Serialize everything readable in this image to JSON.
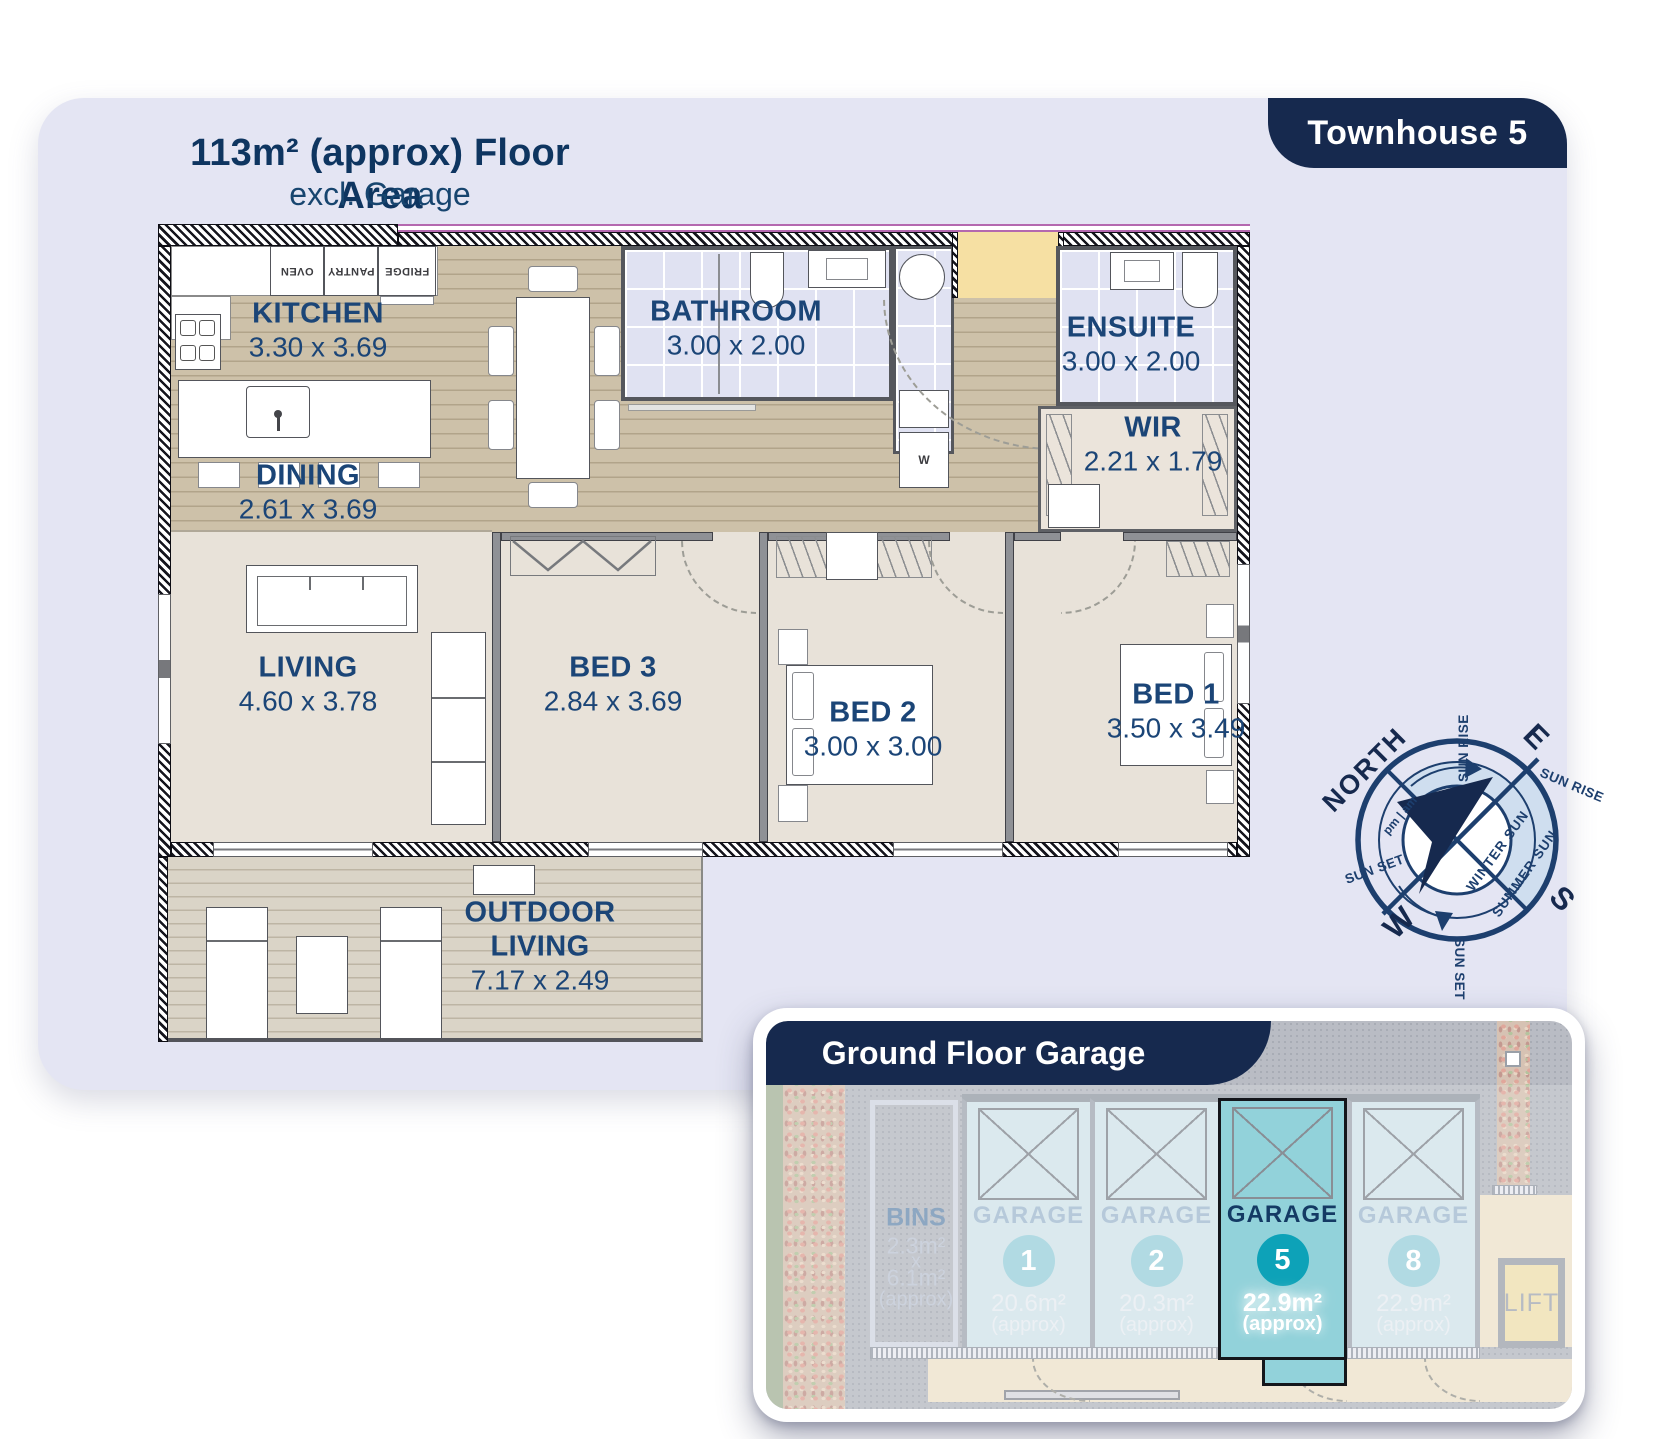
{
  "header": {
    "title": "113m² (approx) Floor Area",
    "subtitle": "excl. Garage",
    "badge": "Townhouse 5"
  },
  "rooms": {
    "kitchen": {
      "name": "KITCHEN",
      "dims": "3.30 x 3.69"
    },
    "dining": {
      "name": "DINING",
      "dims": "2.61 x 3.69"
    },
    "bathroom": {
      "name": "BATHROOM",
      "dims": "3.00 x 2.00"
    },
    "ensuite": {
      "name": "ENSUITE",
      "dims": "3.00 x 2.00"
    },
    "wir": {
      "name": "WIR",
      "dims": "2.21 x 1.79"
    },
    "living": {
      "name": "LIVING",
      "dims": "4.60 x 3.78"
    },
    "bed3": {
      "name": "BED 3",
      "dims": "2.84 x 3.69"
    },
    "bed2": {
      "name": "BED 2",
      "dims": "3.00 x 3.00"
    },
    "bed1": {
      "name": "BED 1",
      "dims": "3.50 x 3.49"
    },
    "outdoor": {
      "name1": "OUTDOOR",
      "name2": "LIVING",
      "dims": "7.17 x 2.49"
    }
  },
  "appliances": {
    "oven": "OVEN",
    "pantry": "PANTRY",
    "fridge": "FRIDGE",
    "washer": "W"
  },
  "compass": {
    "north": "NORTH",
    "east": "E",
    "south": "S",
    "west": "W",
    "sun_rise_top": "SUN RISE",
    "sun_rise_right": "SUN RISE",
    "sun_set_left": "SUN SET",
    "sun_set_bottom": "SUN SET",
    "winter_sun": "WINTER SUN",
    "summer_sun": "SUMMER SUN",
    "meridiem": "pm | am"
  },
  "garage": {
    "title": "Ground Floor Garage",
    "bins": {
      "name": "BINS",
      "area1": "2.3m²",
      "by": "x",
      "area2": "6.1m²",
      "approx": "(approx)"
    },
    "stalls": [
      {
        "label": "GARAGE",
        "number": "1",
        "area": "20.6m²",
        "approx": "(approx)"
      },
      {
        "label": "GARAGE",
        "number": "2",
        "area": "20.3m²",
        "approx": "(approx)"
      },
      {
        "label": "GARAGE",
        "number": "5",
        "area": "22.9m²",
        "approx": "(approx)"
      },
      {
        "label": "GARAGE",
        "number": "8",
        "area": "22.9m²",
        "approx": "(approx)"
      }
    ],
    "lift": "LIFT"
  },
  "colors": {
    "navy": "#16294e",
    "label_blue": "#1b4577",
    "panel": "#e4e5f3",
    "highlight_teal": "#92d2da",
    "badge_teal": "#0da2b8"
  }
}
